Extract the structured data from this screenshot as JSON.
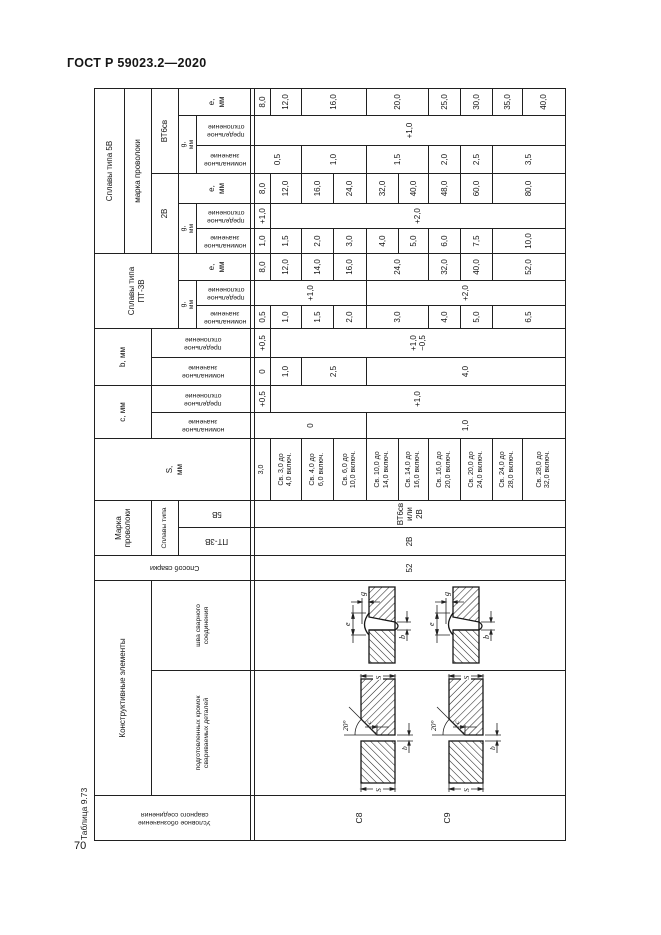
{
  "page": {
    "standard": "ГОСТ Р 59023.2—2020",
    "page_number": "70"
  },
  "table": {
    "caption": "Таблица 9.73",
    "headers": {
      "designation": "Условное обозначение\nсварного соединения",
      "constructive": "Конструктивные элементы",
      "edges": "подготовленных кромок\nсвариваемых деталей",
      "seam": "шва сварного\nсоединения",
      "method": "Способ сварки",
      "wire": "Марка\nпроволоки",
      "alloy_type": "Сплавы типа",
      "alloy_pt": "ПТ-3В",
      "alloy_5v": "5В",
      "s": "S,\nмм",
      "c": "с, мм",
      "b": "b, мм",
      "nominal": "номинальное\nзначение",
      "deviation": "предельное\nотклонение",
      "g": "g,\nмм",
      "e": "е,\nмм",
      "pt_group": "Сплавы типа\nПТ-3В",
      "v5_group": "Сплавы типа 5В",
      "wire_grade": "марка проволоки",
      "w2v": "2В",
      "wvt6": "ВТ6св"
    },
    "values": {
      "method": "52",
      "wire_pt": "2В",
      "wire_5v": "ВТ6св\nили\n2В",
      "c8": "С8",
      "c9": "С9"
    },
    "s_rows": [
      "3,0",
      "Св. 3,0 до\n4,0 включ.",
      "Св. 4,0 до\n6,0 включ.",
      "Св. 6,0 до\n10,0 включ.",
      "Св. 10,0 до\n14,0 включ.",
      "Св. 14,0 до\n16,0 включ.",
      "Св. 16,0 до\n20,0 включ.",
      "Св. 20,0 до\n24,0 включ.",
      "Св. 24,0 до\n28,0 включ.",
      "Св. 28,0 до\n32,0 включ."
    ],
    "columns": {
      "c_nom": [
        {
          "v": "0",
          "r": [
            1,
            4
          ]
        },
        {
          "v": "1,0",
          "r": [
            5,
            10
          ]
        }
      ],
      "c_pred": [
        {
          "v": "+0,5",
          "r": [
            1,
            1
          ]
        },
        {
          "v": "+1,0",
          "r": [
            2,
            10
          ]
        }
      ],
      "b_nom": [
        {
          "v": "0",
          "r": [
            1,
            1
          ]
        },
        {
          "v": "1,0",
          "r": [
            2,
            2
          ]
        },
        {
          "v": "2,5",
          "r": [
            3,
            4
          ]
        },
        {
          "v": "4,0",
          "r": [
            5,
            10
          ]
        }
      ],
      "b_pred": [
        {
          "v": "+0,5",
          "r": [
            1,
            1
          ]
        },
        {
          "v": "+1,0\n−0,5",
          "r": [
            2,
            10
          ]
        }
      ],
      "pt_g_nom": [
        {
          "v": "0,5",
          "r": [
            1,
            1
          ]
        },
        {
          "v": "1,0",
          "r": [
            2,
            2
          ]
        },
        {
          "v": "1,5",
          "r": [
            3,
            3
          ]
        },
        {
          "v": "2,0",
          "r": [
            4,
            4
          ]
        },
        {
          "v": "3,0",
          "r": [
            5,
            6
          ]
        },
        {
          "v": "4,0",
          "r": [
            7,
            7
          ]
        },
        {
          "v": "5,0",
          "r": [
            8,
            8
          ]
        },
        {
          "v": "6,5",
          "r": [
            9,
            10
          ]
        }
      ],
      "pt_g_pred": [
        {
          "v": "+1,0",
          "r": [
            1,
            4
          ]
        },
        {
          "v": "+2,0",
          "r": [
            5,
            10
          ]
        }
      ],
      "pt_e": [
        {
          "v": "8,0",
          "r": [
            1,
            1
          ]
        },
        {
          "v": "12,0",
          "r": [
            2,
            2
          ]
        },
        {
          "v": "14,0",
          "r": [
            3,
            3
          ]
        },
        {
          "v": "16,0",
          "r": [
            4,
            4
          ]
        },
        {
          "v": "24,0",
          "r": [
            5,
            6
          ]
        },
        {
          "v": "32,0",
          "r": [
            7,
            7
          ]
        },
        {
          "v": "40,0",
          "r": [
            8,
            8
          ]
        },
        {
          "v": "52,0",
          "r": [
            9,
            10
          ]
        }
      ],
      "v2_g_nom": [
        {
          "v": "1,0",
          "r": [
            1,
            1
          ]
        },
        {
          "v": "1,5",
          "r": [
            2,
            2
          ]
        },
        {
          "v": "2,0",
          "r": [
            3,
            3
          ]
        },
        {
          "v": "3,0",
          "r": [
            4,
            4
          ]
        },
        {
          "v": "4,0",
          "r": [
            5,
            5
          ]
        },
        {
          "v": "5,0",
          "r": [
            6,
            6
          ]
        },
        {
          "v": "6,0",
          "r": [
            7,
            7
          ]
        },
        {
          "v": "7,5",
          "r": [
            8,
            8
          ]
        },
        {
          "v": "10,0",
          "r": [
            9,
            10
          ]
        }
      ],
      "v2_g_pred": [
        {
          "v": "+1,0",
          "r": [
            1,
            1
          ]
        },
        {
          "v": "+2,0",
          "r": [
            2,
            10
          ]
        }
      ],
      "v2_e": [
        {
          "v": "8,0",
          "r": [
            1,
            1
          ]
        },
        {
          "v": "12,0",
          "r": [
            2,
            2
          ]
        },
        {
          "v": "16,0",
          "r": [
            3,
            3
          ]
        },
        {
          "v": "24,0",
          "r": [
            4,
            4
          ]
        },
        {
          "v": "32,0",
          "r": [
            5,
            5
          ]
        },
        {
          "v": "40,0",
          "r": [
            6,
            6
          ]
        },
        {
          "v": "48,0",
          "r": [
            7,
            7
          ]
        },
        {
          "v": "60,0",
          "r": [
            8,
            8
          ]
        },
        {
          "v": "80,0",
          "r": [
            9,
            10
          ]
        }
      ],
      "vt_g_nom": [
        {
          "v": "0,5",
          "r": [
            1,
            2
          ]
        },
        {
          "v": "1,0",
          "r": [
            3,
            4
          ]
        },
        {
          "v": "1,5",
          "r": [
            5,
            6
          ]
        },
        {
          "v": "2,0",
          "r": [
            7,
            7
          ]
        },
        {
          "v": "2,5",
          "r": [
            8,
            8
          ]
        },
        {
          "v": "3,5",
          "r": [
            9,
            10
          ]
        }
      ],
      "vt_g_pred": [
        {
          "v": "+1,0",
          "r": [
            1,
            10
          ]
        }
      ],
      "vt_e": [
        {
          "v": "8,0",
          "r": [
            1,
            1
          ]
        },
        {
          "v": "12,0",
          "r": [
            2,
            2
          ]
        },
        {
          "v": "16,0",
          "r": [
            3,
            4
          ]
        },
        {
          "v": "20,0",
          "r": [
            5,
            6
          ]
        },
        {
          "v": "25,0",
          "r": [
            7,
            7
          ]
        },
        {
          "v": "30,0",
          "r": [
            8,
            8
          ]
        },
        {
          "v": "35,0",
          "r": [
            9,
            9
          ]
        },
        {
          "v": "40,0",
          "r": [
            10,
            10
          ]
        }
      ]
    },
    "diagram_labels": {
      "angle": "20°",
      "s": "S",
      "b": "b",
      "c": "c",
      "e": "e",
      "g": "g"
    }
  },
  "colors": {
    "ink": "#151515",
    "line": "#202020",
    "background": "#ffffff"
  }
}
